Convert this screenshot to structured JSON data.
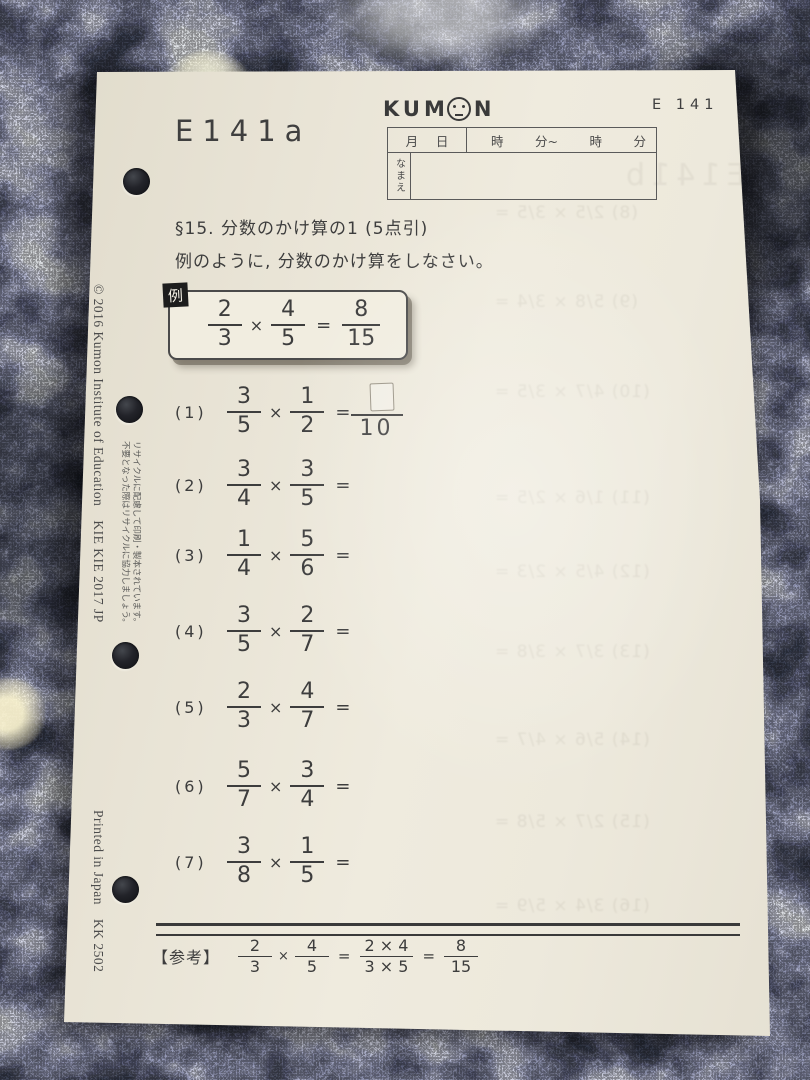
{
  "document": {
    "brand_prefix": "KUM",
    "brand_suffix": "N",
    "page_code": "E 141",
    "worksheet_id": "E141a",
    "symbols": {
      "times": "×",
      "equals": "="
    },
    "header_table": {
      "month": "月",
      "day": "日",
      "hour1": "時",
      "min1": "分~",
      "hour2": "時",
      "min2": "分",
      "name_label": "なまえ"
    },
    "section_heading": "§15. 分数のかけ算の1 (5点引)",
    "instruction": "例のように, 分数のかけ算をしなさい。",
    "example": {
      "label": "例",
      "f1": {
        "num": "2",
        "den": "3"
      },
      "f2": {
        "num": "4",
        "den": "5"
      },
      "result": {
        "num": "8",
        "den": "15"
      }
    },
    "problems": [
      {
        "label": "(1)",
        "f1": {
          "num": "3",
          "den": "5"
        },
        "f2": {
          "num": "1",
          "den": "2"
        },
        "answer_den": "10"
      },
      {
        "label": "(2)",
        "f1": {
          "num": "3",
          "den": "4"
        },
        "f2": {
          "num": "3",
          "den": "5"
        }
      },
      {
        "label": "(3)",
        "f1": {
          "num": "1",
          "den": "4"
        },
        "f2": {
          "num": "5",
          "den": "6"
        }
      },
      {
        "label": "(4)",
        "f1": {
          "num": "3",
          "den": "5"
        },
        "f2": {
          "num": "2",
          "den": "7"
        }
      },
      {
        "label": "(5)",
        "f1": {
          "num": "2",
          "den": "3"
        },
        "f2": {
          "num": "4",
          "den": "7"
        }
      },
      {
        "label": "(6)",
        "f1": {
          "num": "5",
          "den": "7"
        },
        "f2": {
          "num": "3",
          "den": "4"
        }
      },
      {
        "label": "(7)",
        "f1": {
          "num": "3",
          "den": "8"
        },
        "f2": {
          "num": "1",
          "den": "5"
        }
      }
    ],
    "reference": {
      "label": "【参考】",
      "f1": {
        "num": "2",
        "den": "3"
      },
      "f2": {
        "num": "4",
        "den": "5"
      },
      "expanded": {
        "num": "2 × 4",
        "den": "3 × 5"
      },
      "result": {
        "num": "8",
        "den": "15"
      }
    },
    "margin_notes": {
      "copyright": "© 2016 Kumon Institute of Education　KIE KIE 2017 JP",
      "recycle_line1": "リサイクルに配慮して印刷・製本されています。",
      "recycle_line2": "不要となった際はリサイクルに協力しましょう。",
      "printed": "Printed in Japan　KK 2502"
    },
    "ghost_showthrough": {
      "title": "E141b",
      "rows": [
        "(8) 2/5 × 3/5 =",
        "(9) 5/8 × 3/4 =",
        "(10) 4/7 × 3/5 =",
        "(11) 1/6 × 2/5 =",
        "(12) 4/5 × 2/3 =",
        "(13) 3/7 × 3/8 =",
        "(14) 5/6 × 4/7 =",
        "(15) 2/7 × 5/8 =",
        "(16) 3/4 × 5/9 ="
      ]
    }
  },
  "colors": {
    "paper": "#ece7da",
    "ink": "#3d3d3d",
    "granite_dark": "#101113",
    "granite_light": "#a9aeb6",
    "example_shadow": "#5f5a4e"
  }
}
